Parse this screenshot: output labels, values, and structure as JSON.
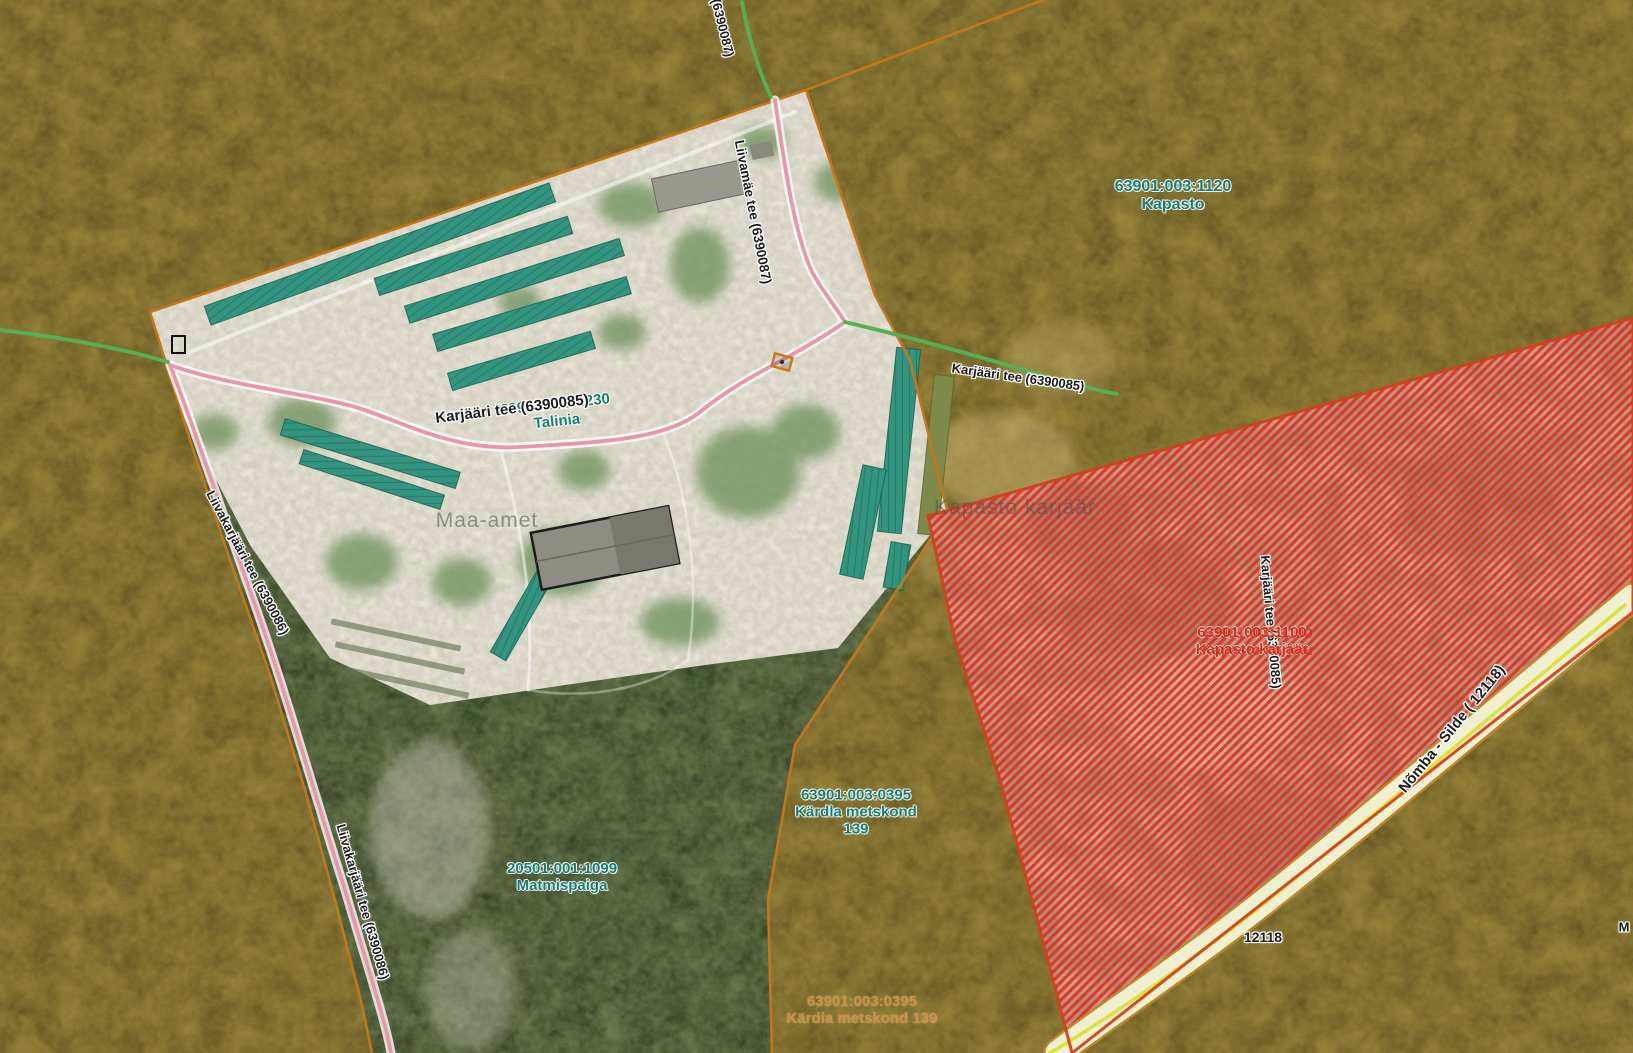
{
  "map": {
    "watermarks": {
      "producer": "Maa-amet",
      "quarry_name": "Kapasto karjäär",
      "edge_fragment": "M"
    },
    "parcels": {
      "kapasto": {
        "code": "63901:003:1120",
        "name": "Kapasto"
      },
      "kardla_metskond": {
        "code": "63901:003:0395",
        "name": "Kärdla metskond",
        "number": "139"
      },
      "kardla_metskond_addr": {
        "code": "63901:003:0395",
        "name": "Kärdla metskond 139"
      },
      "matmispaiga": {
        "code": "20501:001:1099",
        "name": "Matmispaiga"
      },
      "talinia": {
        "code": "63901:001:1230",
        "name": "Talinia"
      },
      "kapasto_karjaar": {
        "code": "63901:003:1100",
        "name": "Kapasto karjäär"
      }
    },
    "roads": {
      "liivamae": "Liivamäe tee (6390087)",
      "liivamae_fragment": "(6390087)",
      "karjaari": "Karjääri tee (6390085)",
      "liivakarjaari": "Liivakarjääri tee (6390086)",
      "nomba_silde": "Nõmba - Silde ( 12118)",
      "nomba_code": "12118"
    },
    "colors": {
      "forest_overlay_olive": "#8f7d36",
      "parcel_boundary": "#c4761a",
      "selected_parcel_hatch": "#e23120",
      "selected_parcel_border": "#d2401e",
      "building_overlay_teal": "#339580",
      "road_minor_pink": "#e897a8",
      "road_local_green": "#55b055",
      "road_main_fill": "#eff0cf",
      "road_main_line": "#dade2c",
      "label_parcel_teal": "#157d6e",
      "label_selected_red": "#cf2d1d",
      "label_address_orange": "#d5903e"
    }
  }
}
